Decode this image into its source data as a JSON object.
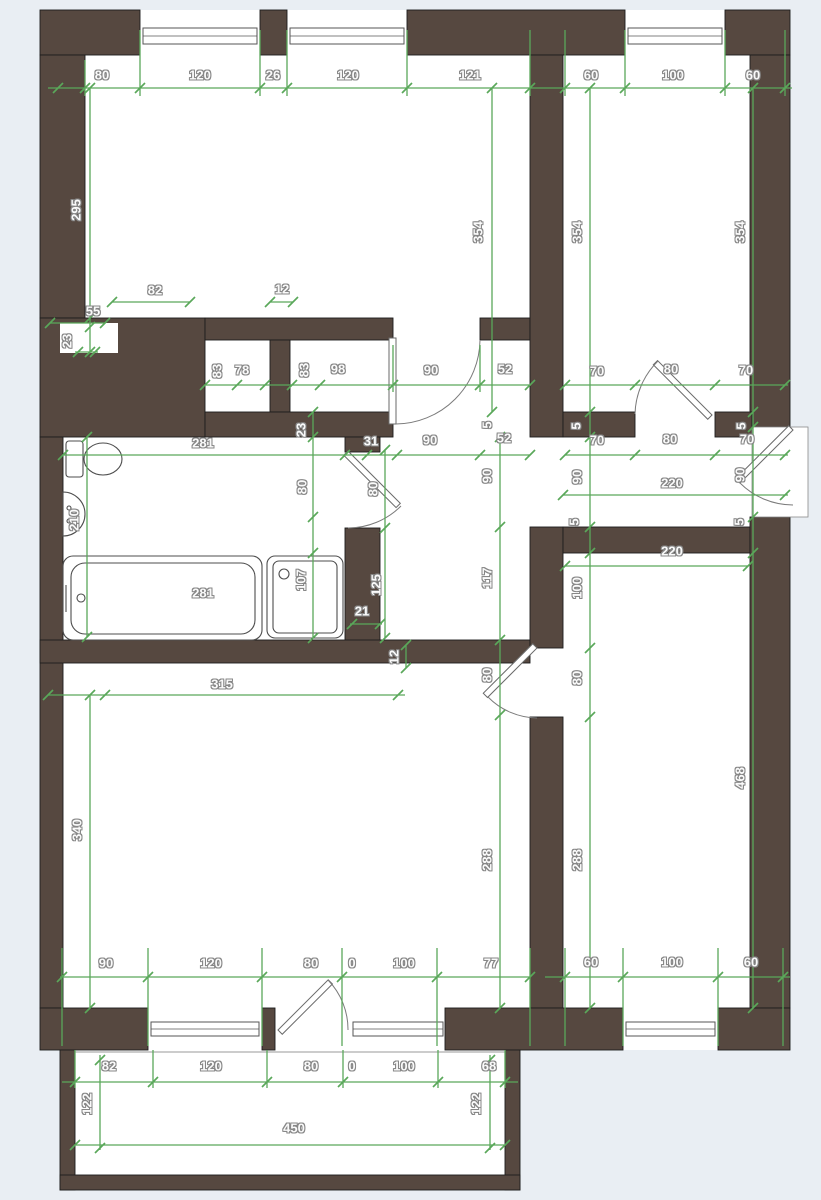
{
  "document_type": "apartment-floor-plan",
  "colors": {
    "wall": "#564840",
    "dimension_green": "#5aa85a",
    "floor": "#ffffff",
    "page_background": "#e9eef3"
  },
  "labels": [
    {
      "text": "80",
      "x": 102,
      "y": 75,
      "rot": 0
    },
    {
      "text": "120",
      "x": 200,
      "y": 75,
      "rot": 0
    },
    {
      "text": "26",
      "x": 273,
      "y": 75,
      "rot": 0
    },
    {
      "text": "120",
      "x": 348,
      "y": 75,
      "rot": 0
    },
    {
      "text": "121",
      "x": 470,
      "y": 75,
      "rot": 0
    },
    {
      "text": "60",
      "x": 591,
      "y": 75,
      "rot": 0
    },
    {
      "text": "100",
      "x": 673,
      "y": 75,
      "rot": 0
    },
    {
      "text": "60",
      "x": 753,
      "y": 75,
      "rot": 0
    },
    {
      "text": "295",
      "x": 76,
      "y": 210,
      "rot": 1
    },
    {
      "text": "354",
      "x": 478,
      "y": 232,
      "rot": 1
    },
    {
      "text": "354",
      "x": 577,
      "y": 232,
      "rot": 1
    },
    {
      "text": "354",
      "x": 740,
      "y": 232,
      "rot": 1
    },
    {
      "text": "82",
      "x": 155,
      "y": 290,
      "rot": 0
    },
    {
      "text": "12",
      "x": 282,
      "y": 289,
      "rot": 0
    },
    {
      "text": "55",
      "x": 93,
      "y": 311,
      "rot": 0
    },
    {
      "text": "23",
      "x": 67,
      "y": 341,
      "rot": 1
    },
    {
      "text": "83",
      "x": 217,
      "y": 371,
      "rot": 1
    },
    {
      "text": "78",
      "x": 242,
      "y": 370,
      "rot": 0
    },
    {
      "text": "83",
      "x": 304,
      "y": 370,
      "rot": 1
    },
    {
      "text": "98",
      "x": 338,
      "y": 369,
      "rot": 0
    },
    {
      "text": "90",
      "x": 431,
      "y": 370,
      "rot": 0
    },
    {
      "text": "52",
      "x": 505,
      "y": 369,
      "rot": 0
    },
    {
      "text": "70",
      "x": 597,
      "y": 371,
      "rot": 0
    },
    {
      "text": "80",
      "x": 671,
      "y": 369,
      "rot": 0
    },
    {
      "text": "70",
      "x": 746,
      "y": 370,
      "rot": 0
    },
    {
      "text": "281",
      "x": 203,
      "y": 443,
      "rot": 0
    },
    {
      "text": "23",
      "x": 301,
      "y": 430,
      "rot": 1
    },
    {
      "text": "31",
      "x": 371,
      "y": 441,
      "rot": 0
    },
    {
      "text": "90",
      "x": 430,
      "y": 440,
      "rot": 0
    },
    {
      "text": "52",
      "x": 504,
      "y": 438,
      "rot": 0
    },
    {
      "text": "5",
      "x": 487,
      "y": 425,
      "rot": 1
    },
    {
      "text": "70",
      "x": 597,
      "y": 440,
      "rot": 0
    },
    {
      "text": "80",
      "x": 670,
      "y": 439,
      "rot": 0
    },
    {
      "text": "70",
      "x": 747,
      "y": 439,
      "rot": 0
    },
    {
      "text": "5",
      "x": 576,
      "y": 426,
      "rot": 1
    },
    {
      "text": "5",
      "x": 741,
      "y": 426,
      "rot": 1
    },
    {
      "text": "90",
      "x": 487,
      "y": 476,
      "rot": 1
    },
    {
      "text": "90",
      "x": 577,
      "y": 477,
      "rot": 1
    },
    {
      "text": "220",
      "x": 672,
      "y": 483,
      "rot": 0
    },
    {
      "text": "90",
      "x": 740,
      "y": 475,
      "rot": 1
    },
    {
      "text": "5",
      "x": 574,
      "y": 522,
      "rot": 1
    },
    {
      "text": "5",
      "x": 739,
      "y": 522,
      "rot": 1
    },
    {
      "text": "80",
      "x": 302,
      "y": 487,
      "rot": 1
    },
    {
      "text": "80",
      "x": 373,
      "y": 489,
      "rot": 1
    },
    {
      "text": "210",
      "x": 74,
      "y": 520,
      "rot": 1
    },
    {
      "text": "117",
      "x": 487,
      "y": 578,
      "rot": 1
    },
    {
      "text": "100",
      "x": 577,
      "y": 588,
      "rot": 1
    },
    {
      "text": "220",
      "x": 672,
      "y": 551,
      "rot": 0
    },
    {
      "text": "281",
      "x": 203,
      "y": 593,
      "rot": 0
    },
    {
      "text": "107",
      "x": 301,
      "y": 580,
      "rot": 1
    },
    {
      "text": "125",
      "x": 376,
      "y": 585,
      "rot": 1
    },
    {
      "text": "21",
      "x": 362,
      "y": 611,
      "rot": 0
    },
    {
      "text": "12",
      "x": 394,
      "y": 657,
      "rot": 1
    },
    {
      "text": "315",
      "x": 222,
      "y": 684,
      "rot": 0
    },
    {
      "text": "340",
      "x": 77,
      "y": 830,
      "rot": 1
    },
    {
      "text": "80",
      "x": 487,
      "y": 675,
      "rot": 1
    },
    {
      "text": "80",
      "x": 577,
      "y": 678,
      "rot": 1
    },
    {
      "text": "288",
      "x": 487,
      "y": 860,
      "rot": 1
    },
    {
      "text": "288",
      "x": 577,
      "y": 860,
      "rot": 1
    },
    {
      "text": "468",
      "x": 740,
      "y": 778,
      "rot": 1
    },
    {
      "text": "90",
      "x": 106,
      "y": 963,
      "rot": 0
    },
    {
      "text": "120",
      "x": 211,
      "y": 963,
      "rot": 0
    },
    {
      "text": "80",
      "x": 311,
      "y": 963,
      "rot": 0
    },
    {
      "text": "0",
      "x": 352,
      "y": 963,
      "rot": 0
    },
    {
      "text": "100",
      "x": 404,
      "y": 963,
      "rot": 0
    },
    {
      "text": "77",
      "x": 491,
      "y": 963,
      "rot": 0
    },
    {
      "text": "60",
      "x": 591,
      "y": 962,
      "rot": 0
    },
    {
      "text": "100",
      "x": 672,
      "y": 962,
      "rot": 0
    },
    {
      "text": "60",
      "x": 751,
      "y": 962,
      "rot": 0
    },
    {
      "text": "82",
      "x": 109,
      "y": 1066,
      "rot": 0
    },
    {
      "text": "120",
      "x": 211,
      "y": 1066,
      "rot": 0
    },
    {
      "text": "80",
      "x": 311,
      "y": 1066,
      "rot": 0
    },
    {
      "text": "0",
      "x": 352,
      "y": 1066,
      "rot": 0
    },
    {
      "text": "100",
      "x": 404,
      "y": 1066,
      "rot": 0
    },
    {
      "text": "68",
      "x": 489,
      "y": 1066,
      "rot": 0
    },
    {
      "text": "122",
      "x": 87,
      "y": 1104,
      "rot": 1
    },
    {
      "text": "122",
      "x": 476,
      "y": 1104,
      "rot": 1
    },
    {
      "text": "450",
      "x": 294,
      "y": 1128,
      "rot": 0
    }
  ]
}
